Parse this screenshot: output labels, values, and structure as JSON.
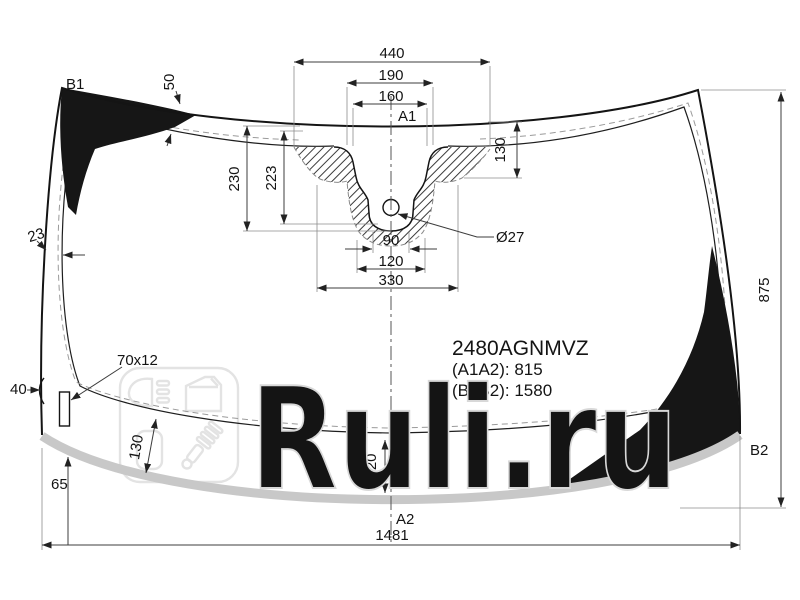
{
  "part": {
    "number": "2480AGNMVZ",
    "a1a2_label": "(A1A2): 815",
    "b1b2_label": "(B1B2): 1580"
  },
  "corner_labels": {
    "a1": "A1",
    "a2": "A2",
    "b1": "B1",
    "b2": "B2"
  },
  "dims": {
    "top_width": "440",
    "sensor_outer": "190",
    "sensor_inner": "160",
    "cam_left_outer": "230",
    "cam_left_inner": "223",
    "cam_right": "130",
    "hole_diameter": "Ø27",
    "hole_width": "90",
    "cam_base_inner": "120",
    "cam_base_outer": "330",
    "frit_top": "50",
    "frit_left": "23",
    "edge_left": "40",
    "bracket_size": "70x12",
    "corner_offset": "65",
    "frit_bottom_left": "130",
    "frit_bottom_center": "120",
    "glass_height": "875",
    "glass_width": "1481"
  },
  "watermark": {
    "brand": "Ruli.ru",
    "badge_icons": [
      "headlight-icon",
      "car-door-icon",
      "seal-profile-icon",
      "shock-absorber-icon"
    ]
  },
  "colors": {
    "line": "#1a1a1a",
    "dim_line": "#3c3c3c",
    "extension_line": "#8c8c8c",
    "dashed_trim": "#9a9a9a",
    "ceramic_patch": "#161616",
    "edge_band": "#c8c8c8",
    "watermark_stroke": "#d8d8d8",
    "background": "#ffffff"
  }
}
